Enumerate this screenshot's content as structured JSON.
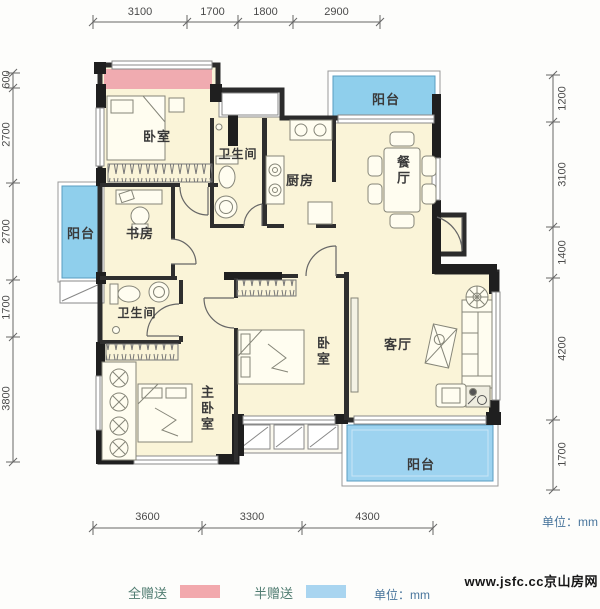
{
  "dimensions": {
    "top": [
      "3100",
      "1700",
      "1800",
      "2900"
    ],
    "bottom": [
      "3600",
      "3300",
      "4300"
    ],
    "left": [
      "600",
      "2700",
      "2700",
      "1700",
      "3800"
    ],
    "right": [
      "1200",
      "3100",
      "1400",
      "4200",
      "1700"
    ],
    "unit_label": "单位：mm"
  },
  "rooms": {
    "bedroom_top": "卧室",
    "bathroom_top": "卫生间",
    "kitchen": "厨房",
    "dining": "餐厅",
    "balcony_top": "阳台",
    "balcony_left": "阳台",
    "study": "书房",
    "bathroom_left": "卫生间",
    "master_bedroom": "主卧室",
    "bedroom_middle": "卧室",
    "living": "客厅",
    "balcony_bottom": "阳台"
  },
  "legend": {
    "full_gift_label": "全赠送",
    "half_gift_label": "半赠送",
    "unit_label": "单位：mm",
    "full_gift_color": "#f2a9ad",
    "half_gift_color": "#a9d5f0"
  },
  "watermark": "www.jsfc.cc京山房网",
  "colors": {
    "floor": "#faf4d8",
    "balcony_blue": "#8fcfec",
    "gift_pink": "#f0abb0",
    "wall_dark": "#262626"
  }
}
